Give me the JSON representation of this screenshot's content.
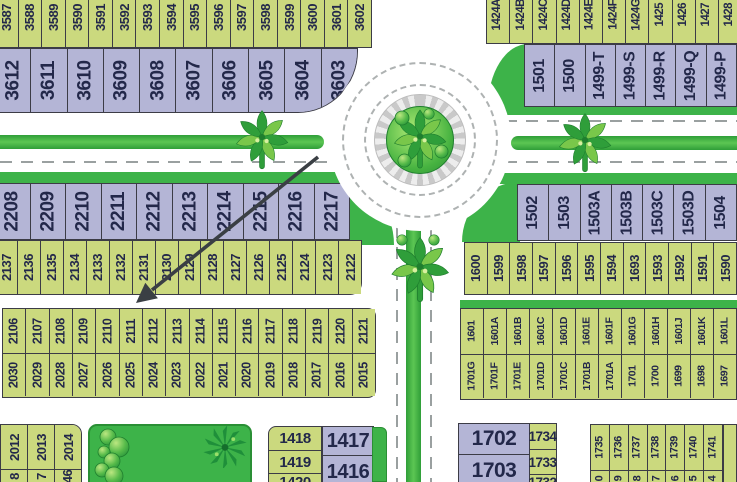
{
  "map": {
    "top_left": {
      "green_row": [
        "3587",
        "3588",
        "3589",
        "3590",
        "3591",
        "3592",
        "3593",
        "3594",
        "3595",
        "3596",
        "3597",
        "3598",
        "3599",
        "3600",
        "3601",
        "3602"
      ],
      "lavender_row": [
        "3612",
        "3611",
        "3610",
        "3609",
        "3608",
        "3607",
        "3606",
        "3605",
        "3604",
        "3603"
      ]
    },
    "top_right": {
      "green_row": [
        "1424A",
        "1424B",
        "1424C",
        "1424D",
        "1424E",
        "1424F",
        "1424G",
        "1425",
        "1426",
        "1427",
        "1428"
      ],
      "lavender_row": [
        "1501",
        "1500",
        "1499-T",
        "1499-S",
        "1499-R",
        "1499-Q",
        "1499-P"
      ]
    },
    "mid_left": {
      "lavender_row": [
        "2208",
        "2209",
        "2210",
        "2211",
        "2212",
        "2213",
        "2214",
        "2215",
        "2216",
        "2217"
      ],
      "green_row": [
        "2137",
        "2136",
        "2135",
        "2134",
        "2133",
        "2132",
        "2131",
        "2130",
        "2129",
        "2128",
        "2127",
        "2126",
        "2125",
        "2124",
        "2123",
        "2122"
      ]
    },
    "mid_right": {
      "lavender_row": [
        "1502",
        "1503",
        "1503A",
        "1503B",
        "1503C",
        "1503D",
        "1504"
      ],
      "green_row": [
        "1600",
        "1599",
        "1598",
        "1597",
        "1596",
        "1595",
        "1594",
        "1693",
        "1593",
        "1592",
        "1591",
        "1590"
      ]
    },
    "west_double_row": {
      "top": [
        "2106",
        "2107",
        "2108",
        "2109",
        "2110",
        "2111",
        "2112",
        "2113",
        "2114",
        "2115",
        "2116",
        "2117",
        "2118",
        "2119",
        "2120",
        "2121"
      ],
      "bottom": [
        "2030",
        "2029",
        "2028",
        "2027",
        "2026",
        "2025",
        "2024",
        "2023",
        "2022",
        "2021",
        "2020",
        "2019",
        "2018",
        "2017",
        "2016",
        "2015"
      ]
    },
    "east_double_row": {
      "top": [
        "1601",
        "1601A",
        "1601B",
        "1601C",
        "1601D",
        "1601E",
        "1601F",
        "1601G",
        "1601H",
        "1601J",
        "1601K",
        "1601L"
      ],
      "bottom": [
        "1701G",
        "1701F",
        "1701E",
        "1701D",
        "1701C",
        "1701B",
        "1701A",
        "1701",
        "1700",
        "1699",
        "1698",
        "1697"
      ]
    },
    "southwest_block": {
      "cells": [
        {
          "top": "2012",
          "bottom": "8"
        },
        {
          "top": "2013",
          "bottom": "7"
        },
        {
          "top": "2014",
          "bottom": "46"
        }
      ]
    },
    "south_center_block": {
      "green_col": [
        "1418",
        "1419",
        "1420"
      ],
      "lavender_col": [
        "1417",
        "1416"
      ]
    },
    "southeast_block": {
      "lavender_col": [
        "1702",
        "1703"
      ],
      "green_col": [
        "1734",
        "1733",
        "1732"
      ]
    },
    "southeast_row": {
      "top": [
        "1735",
        "1736",
        "1737",
        "1738",
        "1739",
        "1740",
        "1741"
      ],
      "bottom": [
        "0",
        "9",
        "8",
        "7",
        "6",
        "5",
        "4"
      ]
    },
    "annotations": {
      "arrow": "black diagonal pointer from roundabout toward plot row 2026/2110"
    },
    "icons": [
      "palm-tree-icon",
      "bush-icon",
      "spiky-tree-icon",
      "roundabout"
    ],
    "colors": {
      "green_plot": "#cbd97e",
      "lavender_plot": "#b4b5d6",
      "plot_text": "#23284a",
      "park_green": "#3db349",
      "road_dash": "#9aa0a0",
      "arrow": "#3a3f44",
      "brick_ring": "#c9c9c9"
    }
  }
}
